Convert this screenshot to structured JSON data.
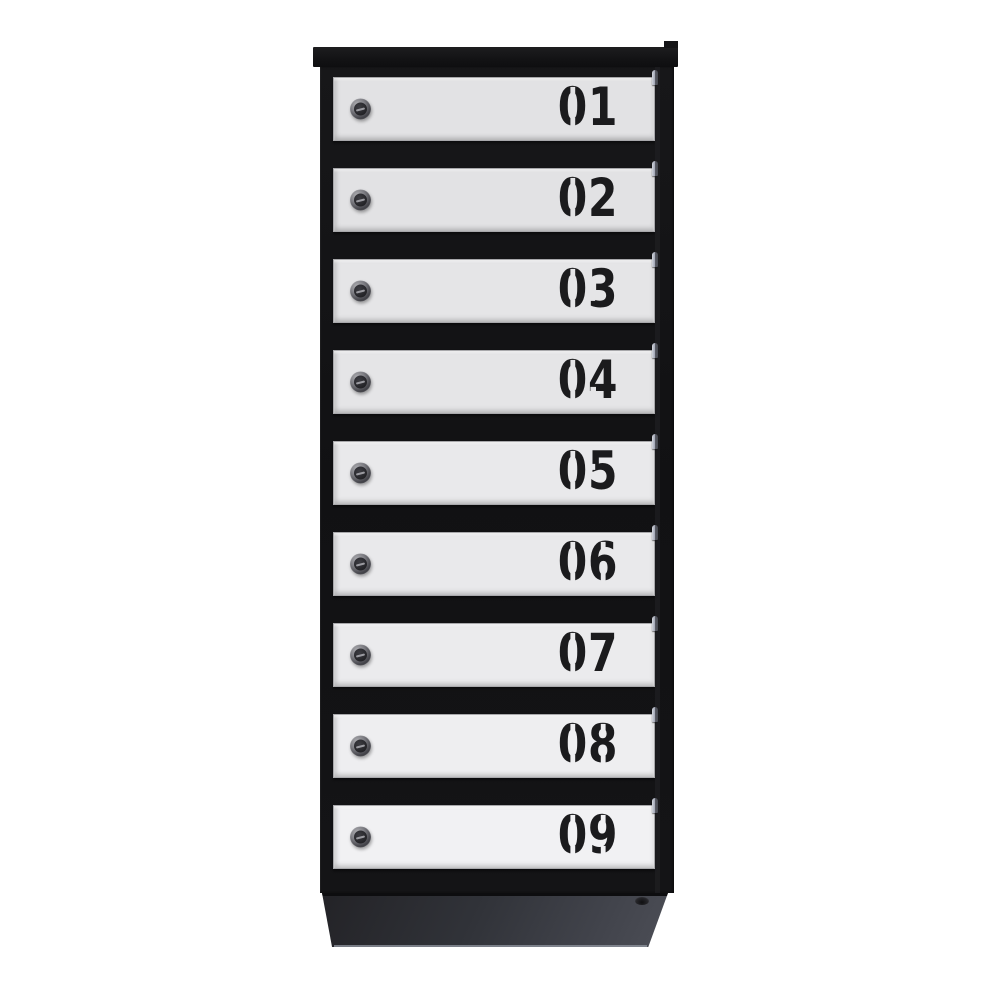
{
  "image": {
    "description": "Front product photo of a 9-compartment vertical apartment mailbox cabinet: black steel frame and base, light gray doors, each door with a round cylinder key lock on the left and a black stencil-style compartment number on the right",
    "background_color": "#ffffff"
  },
  "cabinet": {
    "door_count": 9,
    "doors": [
      {
        "number": "01"
      },
      {
        "number": "02"
      },
      {
        "number": "03"
      },
      {
        "number": "04"
      },
      {
        "number": "05"
      },
      {
        "number": "06"
      },
      {
        "number": "07"
      },
      {
        "number": "08"
      },
      {
        "number": "09"
      }
    ],
    "icons": {
      "lock": "cylinder-lock",
      "keyhole": "keyhole-slot",
      "hinge": "hinge-pin",
      "rivet": "rivet"
    },
    "colors": {
      "frame_black": "#131315",
      "door_face_gray": "#e6e6e8",
      "number_black": "#1b1b1d",
      "base_charcoal": "#3a3c43",
      "hinge_silver": "#9a9fae",
      "lock_metal": "#7b7b81"
    }
  }
}
